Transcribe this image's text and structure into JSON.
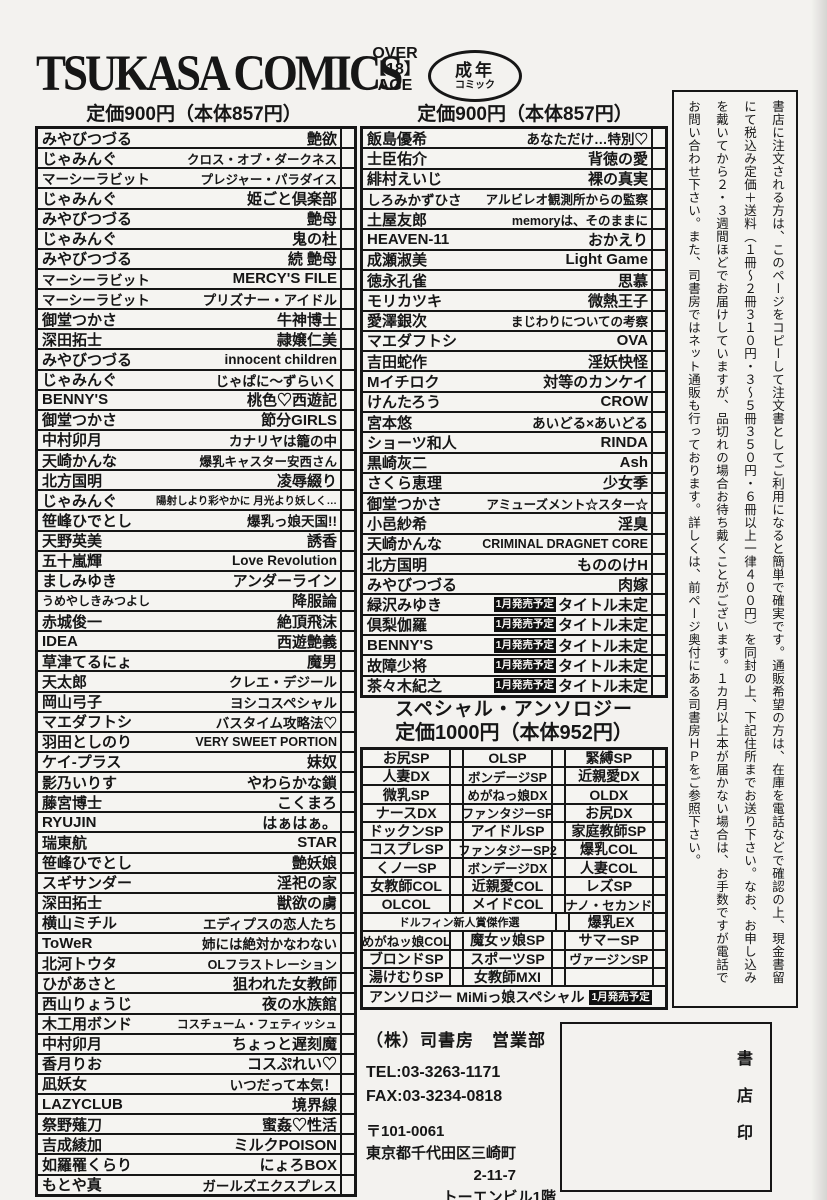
{
  "header": {
    "brand": "TSUKASA COMICS",
    "age_mark": [
      "OVER",
      "【18】",
      "AGE"
    ],
    "adult_badge_line1": "成年",
    "adult_badge_line2": "コミック",
    "price_left": "定価900円（本体857円）",
    "price_right": "定価900円（本体857円）"
  },
  "left_list": [
    {
      "author": "みやびつづる",
      "title": "艶欲"
    },
    {
      "author": "じゃみんぐ",
      "title": "クロス・オブ・ダークネス"
    },
    {
      "author": "マーシーラビット",
      "title": "プレジャー・パラダイス"
    },
    {
      "author": "じゃみんぐ",
      "title": "姫ごと倶楽部"
    },
    {
      "author": "みやびつづる",
      "title": "艶母"
    },
    {
      "author": "じゃみんぐ",
      "title": "鬼の杜"
    },
    {
      "author": "みやびつづる",
      "title": "続 艶母"
    },
    {
      "author": "マーシーラビット",
      "title": "MERCY'S FILE"
    },
    {
      "author": "マーシーラビット",
      "title": "プリズナー・アイドル"
    },
    {
      "author": "御堂つかさ",
      "title": "牛神博士"
    },
    {
      "author": "深田拓士",
      "title": "隷嬢仁美"
    },
    {
      "author": "みやびつづる",
      "title": "innocent children"
    },
    {
      "author": "じゃみんぐ",
      "title": "じゃぱに～ずらいく"
    },
    {
      "author": "BENNY'S",
      "title": "桃色♡西遊記"
    },
    {
      "author": "御堂つかさ",
      "title": "節分GIRLS"
    },
    {
      "author": "中村卯月",
      "title": "カナリヤは籠の中"
    },
    {
      "author": "天崎かんな",
      "title": "爆乳キャスター安西さん"
    },
    {
      "author": "北方国明",
      "title": "凌辱綴り"
    },
    {
      "author": "じゃみんぐ",
      "title": "陽射しより彩やかに 月光より妖しく…"
    },
    {
      "author": "笹峰ひでとし",
      "title": "爆乳っ娘天国!!"
    },
    {
      "author": "天野英美",
      "title": "誘香"
    },
    {
      "author": "五十嵐輝",
      "title": "Love Revolution"
    },
    {
      "author": "ましみゆき",
      "title": "アンダーライン"
    },
    {
      "author": "うめやしきみつよし",
      "title": "降服論"
    },
    {
      "author": "赤城俊一",
      "title": "絶頂飛沫"
    },
    {
      "author": "IDEA",
      "title": "西遊艶義"
    },
    {
      "author": "草津てるにょ",
      "title": "魔男"
    },
    {
      "author": "天太郎",
      "title": "クレエ・デジール"
    },
    {
      "author": "岡山弓子",
      "title": "ヨシコスペシャル"
    },
    {
      "author": "マエダフトシ",
      "title": "バスタイム攻略法♡"
    },
    {
      "author": "羽田としのり",
      "title": "VERY SWEET PORTION"
    },
    {
      "author": "ケイ-プラス",
      "title": "妹奴"
    },
    {
      "author": "影乃いりす",
      "title": "やわらかな鎖"
    },
    {
      "author": "藤宮博士",
      "title": "こくまろ"
    },
    {
      "author": "RYUJIN",
      "title": "はぁはぁ。"
    },
    {
      "author": "瑞東航",
      "title": "STAR"
    },
    {
      "author": "笹峰ひでとし",
      "title": "艶妖娘"
    },
    {
      "author": "スギサンダー",
      "title": "淫祀の家"
    },
    {
      "author": "深田拓士",
      "title": "獣欲の虜"
    },
    {
      "author": "横山ミチル",
      "title": "エディプスの恋人たち"
    },
    {
      "author": "ToWeR",
      "title": "姉には絶対かなわない"
    },
    {
      "author": "北河トウタ",
      "title": "OLフラストレーション"
    },
    {
      "author": "ひがあさと",
      "title": "狙われた女教師"
    },
    {
      "author": "西山りょうじ",
      "title": "夜の水族館"
    },
    {
      "author": "木工用ボンド",
      "title": "コスチューム・フェティッシュ"
    },
    {
      "author": "中村卯月",
      "title": "ちょっと遅刻魔"
    },
    {
      "author": "香月りお",
      "title": "コスぷれい♡"
    },
    {
      "author": "凪妖女",
      "title": "いつだって本気！"
    },
    {
      "author": "LAZYCLUB",
      "title": "境界線"
    },
    {
      "author": "祭野薙刀",
      "title": "蜜姦♡性活"
    },
    {
      "author": "吉成綾加",
      "title": "ミルクPOISON"
    },
    {
      "author": "如羅罹くらり",
      "title": "にょろBOX"
    },
    {
      "author": "もとや真",
      "title": "ガールズエクスプレス"
    }
  ],
  "right_list": [
    {
      "author": "飯島優希",
      "title": "あなただけ…特別♡"
    },
    {
      "author": "士臣佑介",
      "title": "背徳の愛"
    },
    {
      "author": "緋村えいじ",
      "title": "裸の真実"
    },
    {
      "author": "しろみかずひさ",
      "title": "アルビレオ観測所からの監察"
    },
    {
      "author": "土屋友郎",
      "title": "memoryは、そのままに"
    },
    {
      "author": "HEAVEN-11",
      "title": "おかえり"
    },
    {
      "author": "成瀬淑美",
      "title": "Light Game"
    },
    {
      "author": "徳永孔雀",
      "title": "思慕"
    },
    {
      "author": "モリカツキ",
      "title": "微熱王子"
    },
    {
      "author": "愛澤銀次",
      "title": "まじわりについての考察"
    },
    {
      "author": "マエダフトシ",
      "title": "OVA"
    },
    {
      "author": "吉田蛇作",
      "title": "淫妖快怪"
    },
    {
      "author": "Mイチロク",
      "title": "対等のカンケイ"
    },
    {
      "author": "けんたろう",
      "title": "CROW"
    },
    {
      "author": "宮本悠",
      "title": "あいどる×あいどる"
    },
    {
      "author": "ショーツ和人",
      "title": "RINDA"
    },
    {
      "author": "黒崎灰二",
      "title": "Ash"
    },
    {
      "author": "さくら恵理",
      "title": "少女季"
    },
    {
      "author": "御堂つかさ",
      "title": "アミューズメント☆スター☆"
    },
    {
      "author": "小邑紗希",
      "title": "淫臭"
    },
    {
      "author": "天崎かんな",
      "title": "CRIMINAL DRAGNET CORE"
    },
    {
      "author": "北方国明",
      "title": "もののけH"
    },
    {
      "author": "みやびつづる",
      "title": "肉嫁"
    },
    {
      "author": "緑沢みゆき",
      "badge": "1月発売予定",
      "title": "タイトル未定"
    },
    {
      "author": "倶梨伽羅",
      "badge": "1月発売予定",
      "title": "タイトル未定"
    },
    {
      "author": "BENNY'S",
      "badge": "1月発売予定",
      "title": "タイトル未定"
    },
    {
      "author": "故障少将",
      "badge": "1月発売予定",
      "title": "タイトル未定"
    },
    {
      "author": "茶々木紀之",
      "badge": "1月発売予定",
      "title": "タイトル未定"
    }
  ],
  "anthology": {
    "title": "スペシャル・アンソロジー",
    "price": "定価1000円（本体952円）",
    "grid_rows": [
      {
        "cells": [
          "お尻SP",
          "OLSP",
          "緊縛SP"
        ]
      },
      {
        "cells": [
          "人妻DX",
          "ボンデージSP",
          "近親愛DX"
        ]
      },
      {
        "cells": [
          "微乳SP",
          "めがねっ娘DX",
          "OLDX"
        ]
      },
      {
        "cells": [
          "ナースDX",
          "ファンタジーSP",
          "お尻DX"
        ]
      },
      {
        "cells": [
          "ドックンSP",
          "アイドルSP",
          "家庭教師SP"
        ]
      },
      {
        "cells": [
          "コスプレSP",
          "ファンタジーSP2",
          "爆乳COL"
        ]
      },
      {
        "cells": [
          "くノ一SP",
          "ボンデージDX",
          "人妻COL"
        ]
      },
      {
        "cells": [
          "女教師COL",
          "近親愛COL",
          "レズSP"
        ]
      },
      {
        "cells": [
          "OLCOL",
          "メイドCOL",
          "ナノ・セカンド"
        ]
      },
      {
        "span2": true,
        "cells": [
          "ドルフィン新人賞傑作選",
          "爆乳EX"
        ]
      },
      {
        "cells": [
          "めがねッ娘COL",
          "魔女ッ娘SP",
          "サマーSP"
        ]
      },
      {
        "cells": [
          "ブロンドSP",
          "スポーツSP",
          "ヴァージンSP"
        ]
      },
      {
        "cells": [
          "湯けむりSP",
          "女教師MXI",
          ""
        ]
      }
    ],
    "final_row": {
      "label": "アンソロジー MiMiっ娘スペシャル",
      "badge": "1月発売予定"
    }
  },
  "order_note": {
    "columns": [
      "書店に注文される方は、このページをコピーして注文書としてご利用になると簡単で確実です。通販希望の方は、在庫を電話などで確認の上、現金書留",
      "にて税込み定価＋送料（１冊～２冊３１０円・３～５冊３５０円・６冊以上一律４００円）を同封の上、下記住所までお送り下さい。なお、お申し込み",
      "を戴いてから２・３週間ほどでお届けしていますが、品切れの場合お待ち戴くことがございます。１カ月以上本が届かない場合は、お手数ですが電話で",
      "お問い合わせ下さい。また、司書房ではネット通販も行っております。詳しくは、前ページ奥付にある司書房ＨＰをご参照下さい。"
    ]
  },
  "publisher": {
    "company": "（株）司書房　営業部",
    "tel": "TEL:03-3263-1171",
    "fax": "FAX:03-3234-0818",
    "postal": "〒101-0061",
    "address1": "東京都千代田区三崎町",
    "address2": "2-11-7",
    "address3": "トーエンビル1階"
  },
  "stamp_box_label": "書店印"
}
